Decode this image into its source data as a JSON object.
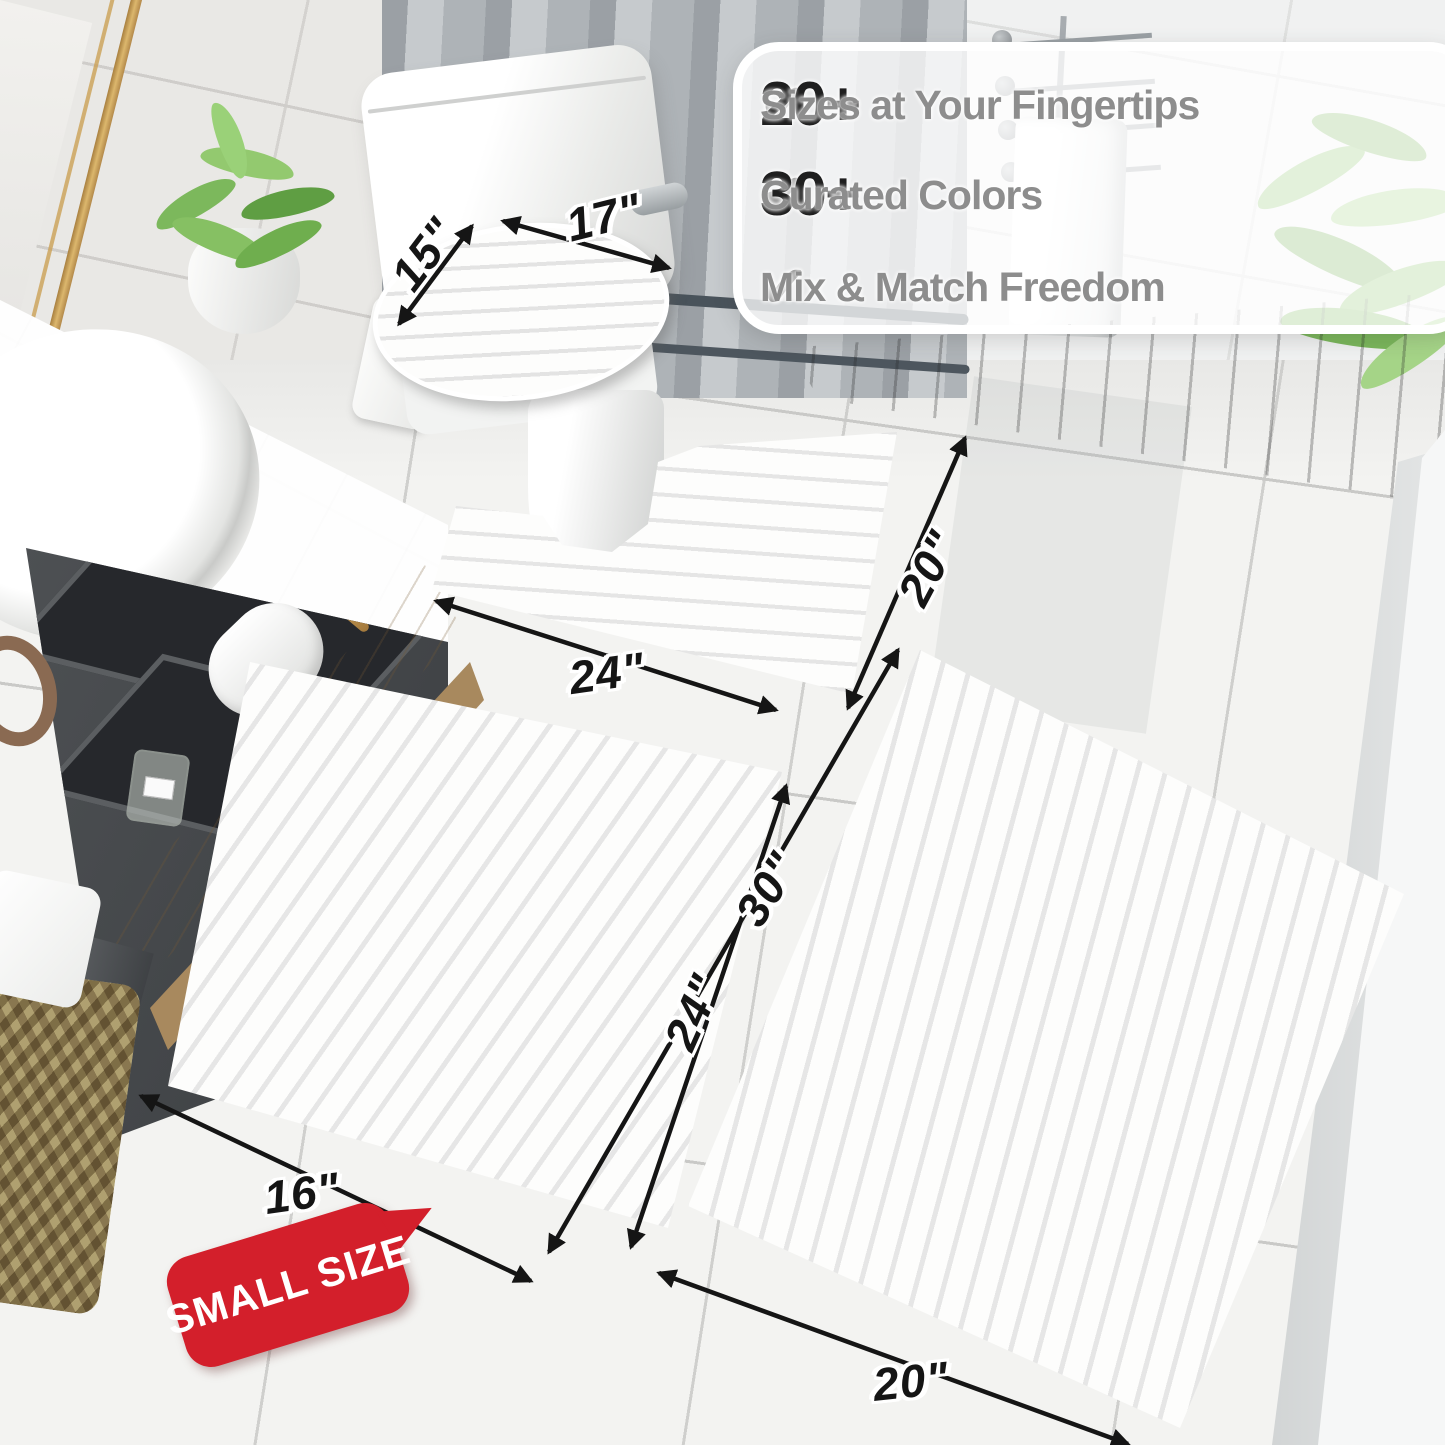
{
  "callout": {
    "check_icon": "✔",
    "rows": [
      {
        "stat": "20+",
        "label": "Sizes at Your Fingertips"
      },
      {
        "stat": "30+",
        "label": "Curated Colors"
      },
      {
        "label": "Mix & Match Freedom"
      }
    ]
  },
  "dimensions": {
    "lid_depth": "15\"",
    "lid_width": "17\"",
    "contour_width": "24\"",
    "contour_depth": "20\"",
    "small_rug_length": "24\"",
    "large_rug_length": "30\"",
    "small_rug_width": "16\"",
    "large_rug_width": "20\""
  },
  "badge": {
    "text": "SMALL SIZE"
  },
  "colors": {
    "badge_red": "#d31f2b",
    "dim_text": "#151515",
    "stat_text": "#1f1f1f",
    "callout_label_gray": "#8d8d8d",
    "check_gray": "#8f8f8f",
    "plant_green": "#85bd63",
    "accent_gold": "#c9a35c"
  }
}
